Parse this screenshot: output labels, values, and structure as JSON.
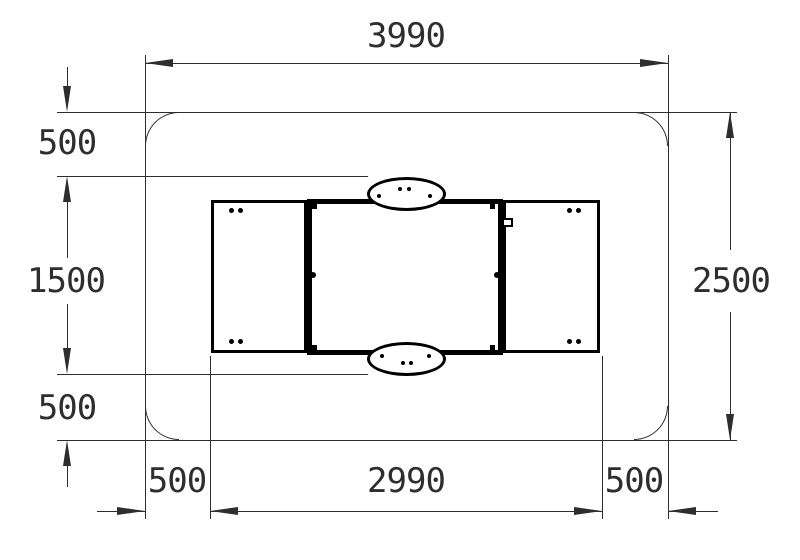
{
  "drawing": {
    "type": "technical-plan-view",
    "units": "mm",
    "colors": {
      "line": "#2e2e2e",
      "object": "#000000",
      "background": "#ffffff"
    },
    "dims": {
      "top_width": "3990",
      "right_height": "2500",
      "left_top": "500",
      "left_middle": "1500",
      "left_bottom": "500",
      "bottom_left": "500",
      "bottom_middle": "2990",
      "bottom_right": "500"
    }
  }
}
